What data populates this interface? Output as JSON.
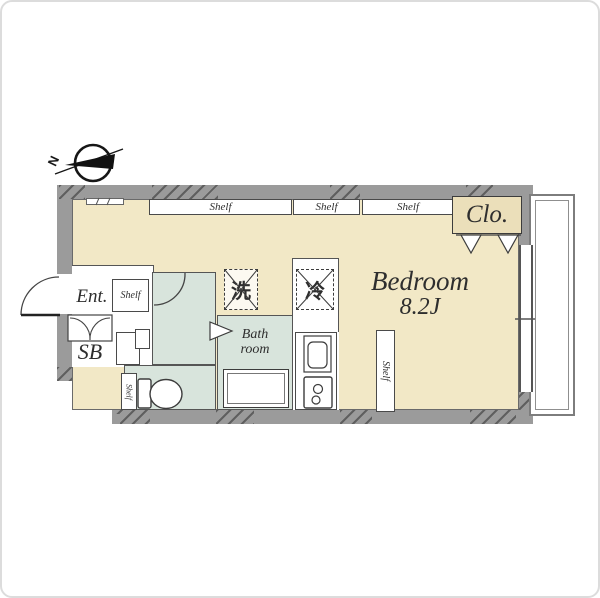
{
  "compass": {
    "north_label": "N"
  },
  "rooms": {
    "bedroom_name": "Bedroom",
    "bedroom_size": "8.2J",
    "closet_label": "Clo.",
    "entrance_label": "Ent.",
    "shoe_box_label": "SB",
    "bath_label_line1": "Bath",
    "bath_label_line2": "room"
  },
  "appliances": {
    "washer_label": "洗",
    "fridge_label": "冷"
  },
  "shelves": {
    "top_left_label": "Shelf",
    "top_middle_label": "Shelf",
    "top_right_label": "Shelf",
    "entrance_shelf_label": "Shelf",
    "bedroom_side_shelf_label": "Shelf",
    "toilet_side_shelf_label": "Shelf"
  },
  "colors": {
    "floor": "#F2E8C6",
    "wet_area": "#D8E4DC",
    "wall": "#9B9B9B",
    "closet_fill": "#EBDFBA",
    "line": "#3C3C3C",
    "balcony_line": "#8A8A8A"
  }
}
